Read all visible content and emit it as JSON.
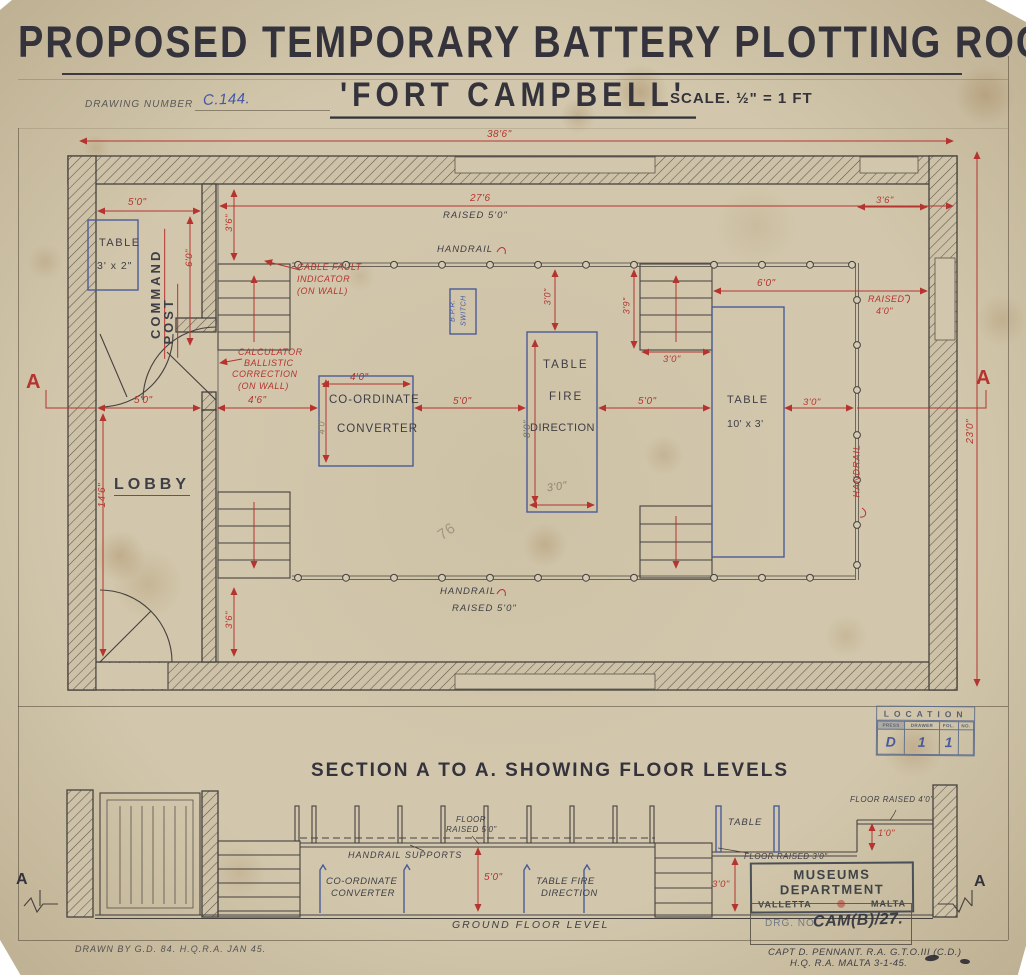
{
  "header": {
    "title": "PROPOSED TEMPORARY BATTERY PLOTTING ROOM",
    "subtitle": "'FORT CAMPBELL'",
    "drawing_number_label": "DRAWING NUMBER",
    "drawing_number": "C.144.",
    "scale": "SCALE. ½\" = 1 FT"
  },
  "plan": {
    "dim_38_6": "38'6\"",
    "dim_27_6": "27'6",
    "raised_5_0_top": "RAISED 5'0\"",
    "handrail_top": "HANDRAIL",
    "dim_5_0_command": "5'0\"",
    "dim_3_6_left": "3'6\"",
    "dim_6_0_command": "6'0\"",
    "cp_table_1": "TABLE",
    "cp_table_2": "3' x 2\"",
    "command": "COMMAND",
    "post": "POST",
    "cable_fault": [
      "CABLE FAULT",
      "INDICATOR",
      "(ON WALL)"
    ],
    "calculator": [
      "CALCULATOR",
      "BALLISTIC",
      "CORRECTION",
      "(ON WALL)"
    ],
    "bpr_1": "B.P.R.",
    "bpr_2": "SWITCH",
    "converter_1": "CO-ORDINATE",
    "converter_2": "CONVERTER",
    "dim_4_0_converter": "4'0\"",
    "dim_4_0_converter_v": "4'0\"",
    "dim_5_0_a": "5'0\"",
    "fire_1": "TABLE",
    "fire_2": "FIRE",
    "fire_3": "DIRECTION",
    "dim_8_0_fire": "8'0\"",
    "dim_3_0_fire_top": "3'0\"",
    "dim_3_0_fire_bottom": "3'0\"",
    "dim_3_9_stairs": "3'9\"",
    "dim_3_0_stairs": "3'0\"",
    "dim_6_0_right": "6'0\"",
    "raised_4_0_1": "RAISED",
    "raised_4_0_2": "4'0\"",
    "dim_3_6_right": "3'6\"",
    "dim_5_0_b": "5'0\"",
    "table_1": "TABLE",
    "table_2": "10' x 3'",
    "dim_3_0_table": "3'0\"",
    "handrail_right": "HANDRAIL",
    "dim_23_0": "23'0\"",
    "section_marker": "A",
    "dim_5_0_lobby": "5'0\"",
    "dim_4_6_lobby": "4'6\"",
    "lobby": "LOBBY",
    "dim_14_6": "14'6\"",
    "handrail_bottom": "HANDRAIL",
    "raised_5_0_bottom": "RAISED 5'0\"",
    "dim_3_6_bottom": "3'6\"",
    "pencil_note": "76"
  },
  "location_stamp": {
    "title": "LOCATION",
    "columns": [
      "PRESS",
      "DRAWER",
      "FOL.",
      "NO."
    ],
    "values": [
      "D",
      "1",
      "1",
      ""
    ]
  },
  "section": {
    "title": "SECTION A TO A. SHOWING FLOOR LEVELS",
    "floor_raised_5_0_1": "FLOOR",
    "floor_raised_5_0_2": "RAISED 5'0\"",
    "handrail_supports": "HANDRAIL SUPPORTS",
    "converter_1": "CO-ORDINATE",
    "converter_2": "CONVERTER",
    "dim_5_0": "5'0\"",
    "fire_1": "TABLE FIRE",
    "fire_2": "DIRECTION",
    "table": "TABLE",
    "floor_raised_4_0": "FLOOR RAISED 4'0\"",
    "dim_1_0": "1'0\"",
    "floor_raised_3_0": "FLOOR RAISED 3'0\"",
    "dim_3_0": "3'0\"",
    "ground": "GROUND FLOOR LEVEL",
    "marker": "A"
  },
  "stamps": {
    "museums_title": "MUSEUMS DEPARTMENT",
    "museums_city": "VALLETTA",
    "museums_country": "MALTA",
    "drg_label": "DRG. NO'",
    "drg_value": "CAM(B)/27."
  },
  "notes": {
    "drawn_by": "DRAWN BY G.D. 84. H.Q.R.A. JAN 45.",
    "sig_1": "CAPT D. PENNANT. R.A. G.T.O.III (C.D.)",
    "sig_2": "H.Q. R.A. MALTA 3-1-45."
  }
}
